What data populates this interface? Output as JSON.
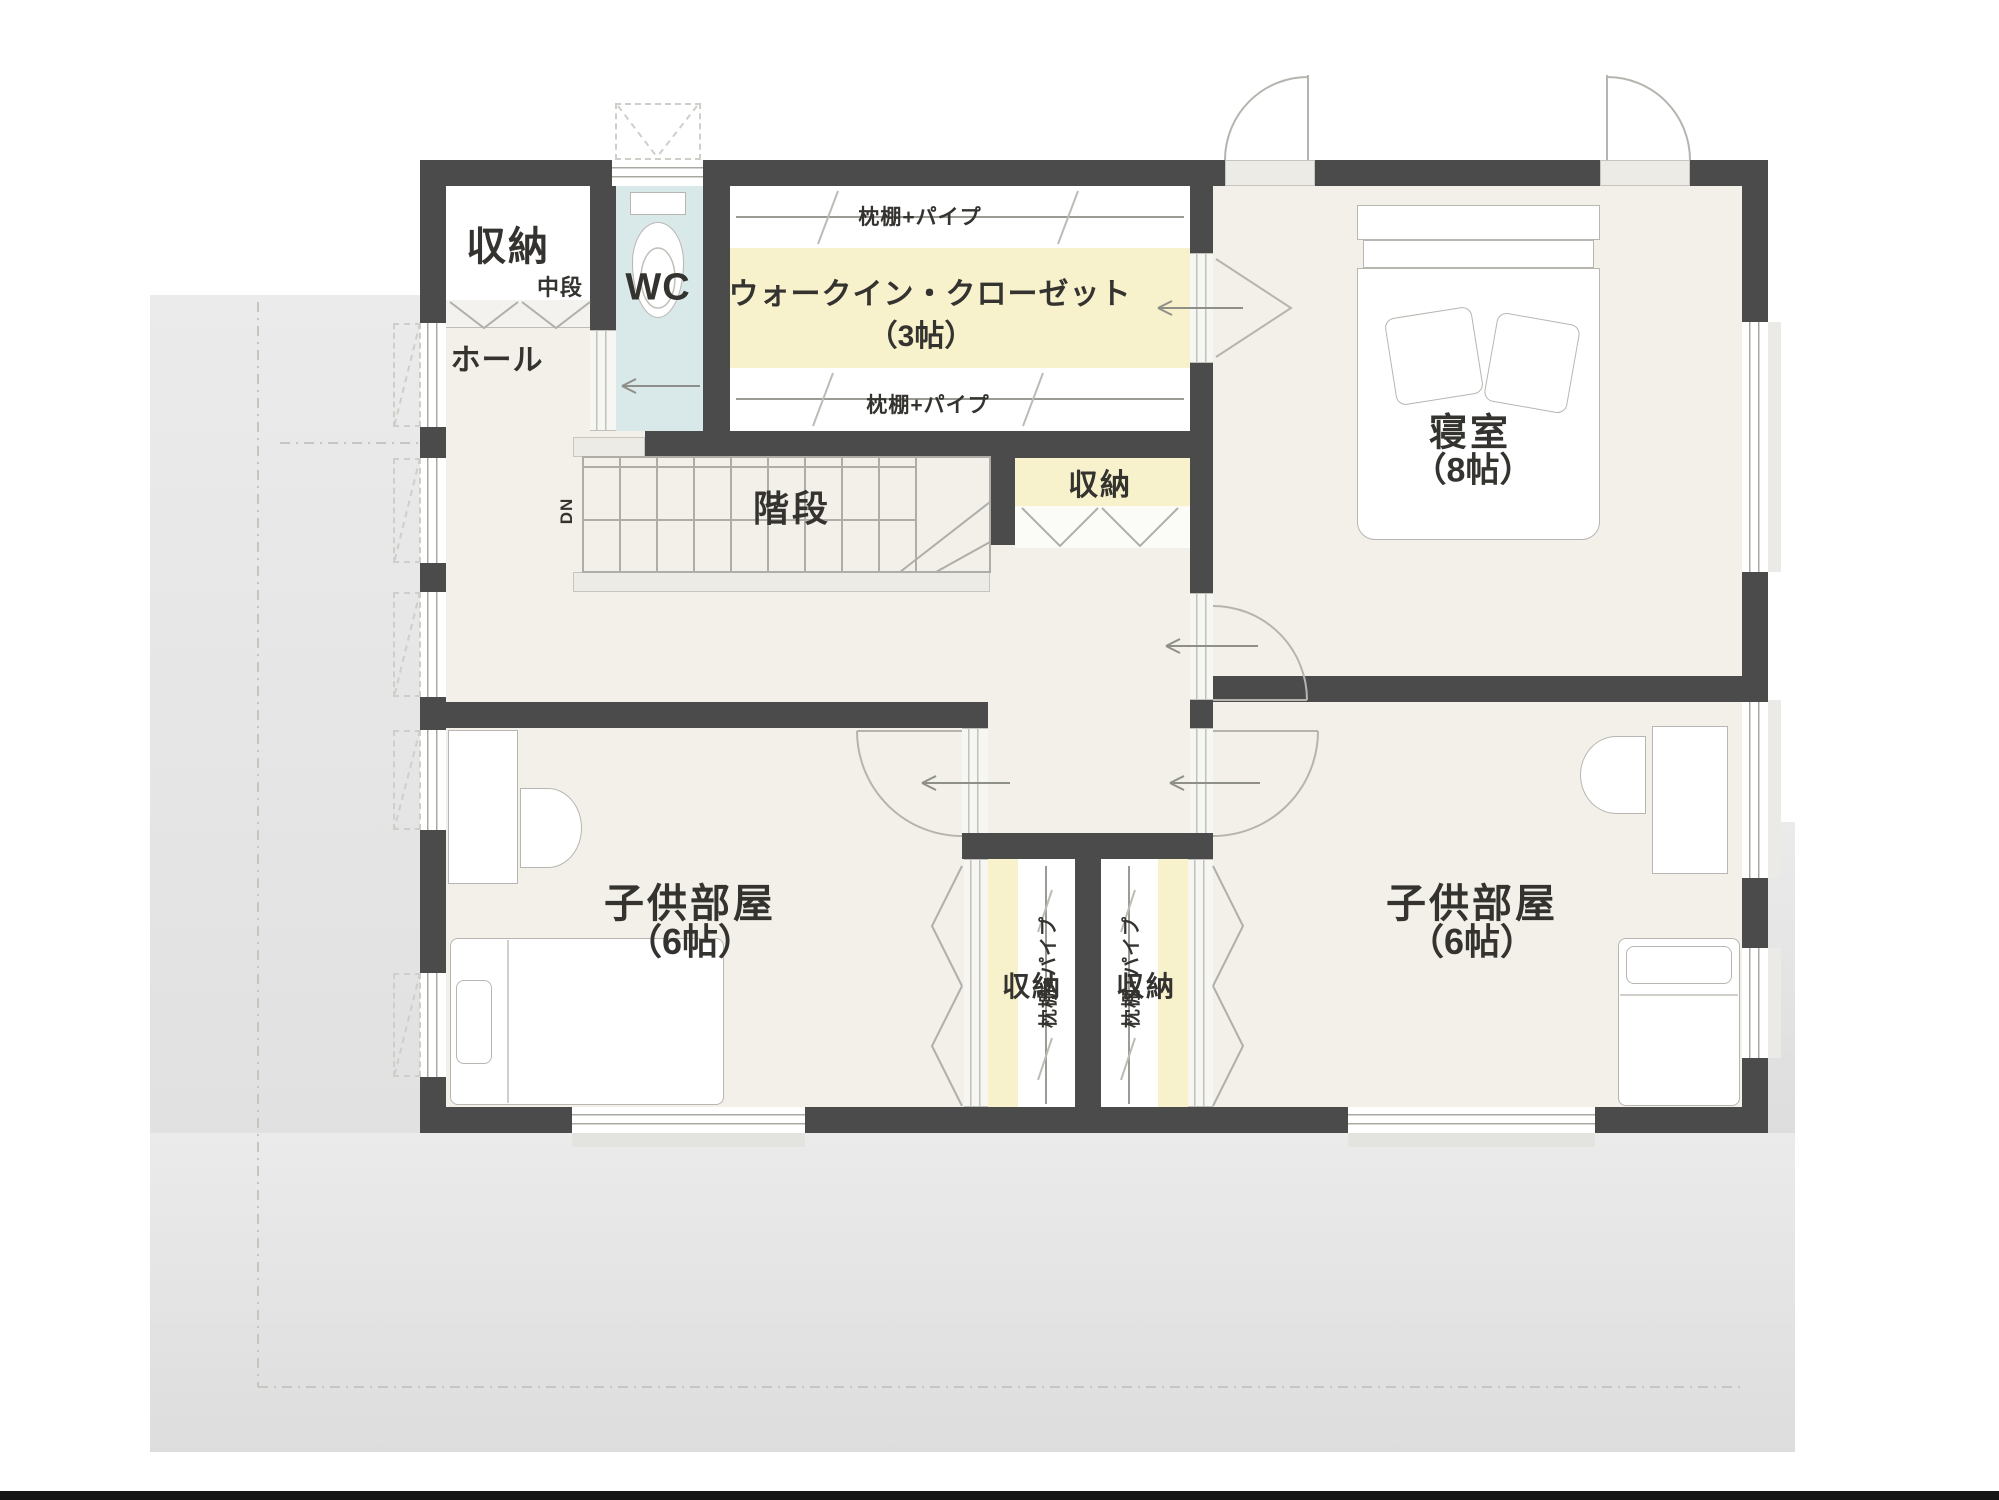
{
  "rooms": {
    "storage_nw": {
      "name": "収納",
      "shelf": "中段"
    },
    "wc": {
      "name": "WC"
    },
    "hall": {
      "name": "ホール"
    },
    "wic": {
      "name": "ウォークイン・クローゼット",
      "size": "（3帖）",
      "shelf_top": "枕棚+パイプ",
      "shelf_bottom": "枕棚+パイプ"
    },
    "bedroom": {
      "name": "寝室",
      "size": "（8帖）"
    },
    "stairs": {
      "name": "階段",
      "dn": "DN"
    },
    "storage_mid": {
      "name": "収納"
    },
    "child_left": {
      "name": "子供部屋",
      "size": "（6帖）"
    },
    "child_right": {
      "name": "子供部屋",
      "size": "（6帖）"
    },
    "closet_left": {
      "name": "収納",
      "shelf": "枕棚+パイプ"
    },
    "closet_right": {
      "name": "収納",
      "shelf": "枕棚+パイプ"
    }
  },
  "colors": {
    "wall": "#4b4b4b",
    "floor": "#f2f0e9",
    "closet_yellow": "#f7f2cc",
    "wc_blue": "#d9e8e9",
    "white": "#ffffff",
    "surround_a": "#ebebeb",
    "surround_b": "#dddddd",
    "line": "#a9a9a2"
  }
}
